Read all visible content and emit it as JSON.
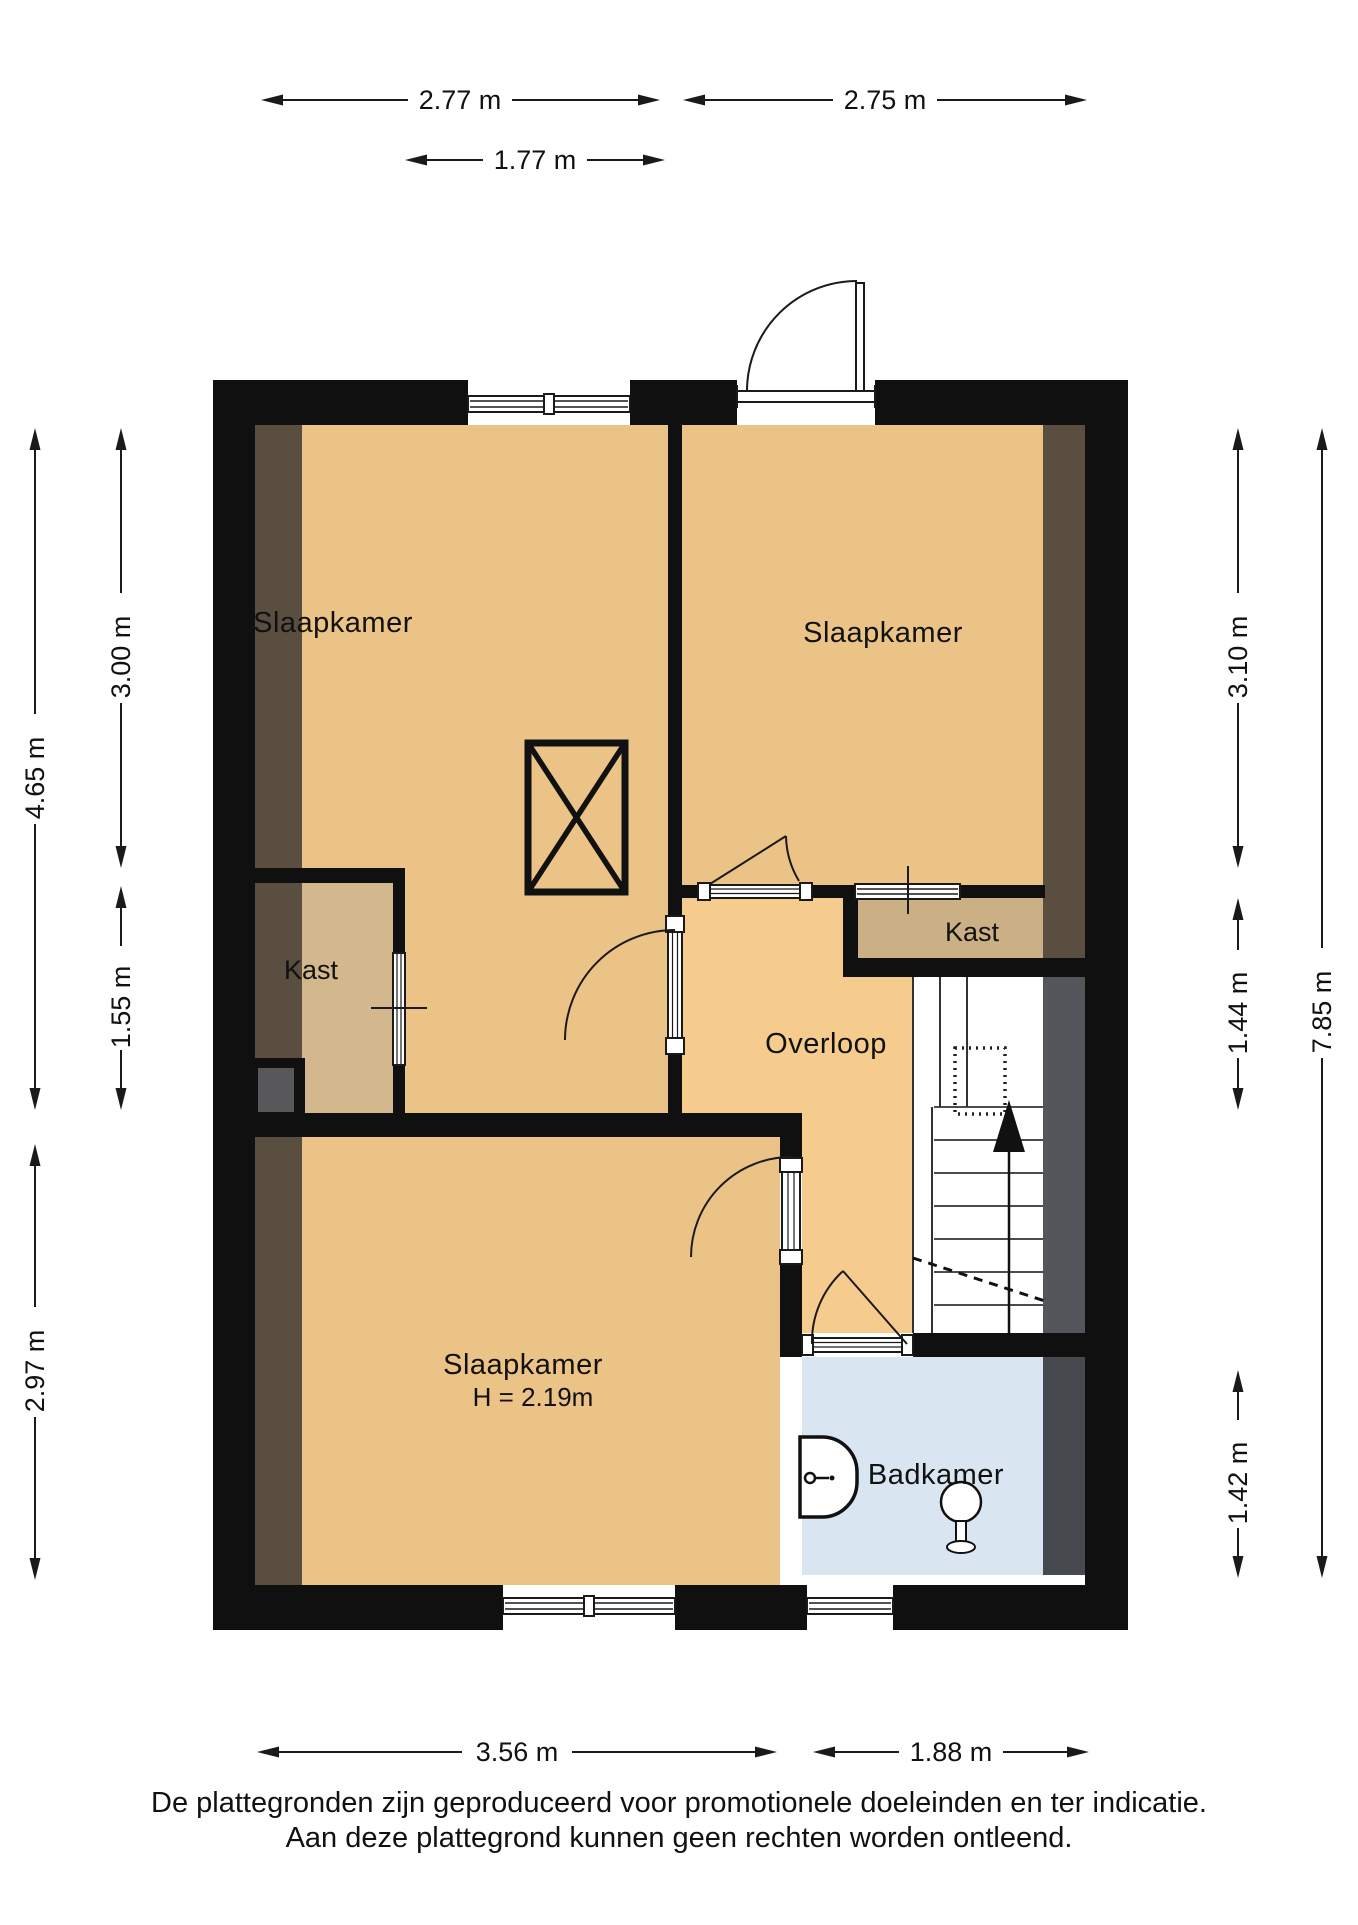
{
  "rooms": {
    "bedroom_top_left": "Slaapkamer",
    "bedroom_top_right": "Slaapkamer",
    "bedroom_bottom": "Slaapkamer",
    "bedroom_bottom_height": "H = 2.19m",
    "closet_left": "Kast",
    "closet_right": "Kast",
    "landing": "Overloop",
    "bathroom": "Badkamer"
  },
  "dimensions": {
    "top_left_width": "2.77 m",
    "top_right_width": "2.75 m",
    "top_inner_width": "1.77 m",
    "left_total": "4.65 m",
    "left_upper": "3.00 m",
    "left_lower": "1.55 m",
    "left_bottom": "2.97 m",
    "right_upper": "3.10 m",
    "right_mid": "1.44 m",
    "right_total": "7.85 m",
    "right_bottom": "1.42 m",
    "bottom_left": "3.56 m",
    "bottom_right": "1.88 m"
  },
  "footer": {
    "line1": "De plattegronden zijn geproduceerd voor promotionele doeleinden en ter indicatie.",
    "line2": "Aan deze plattegrond kunnen geen rechten worden ontleend."
  },
  "colors": {
    "wall": "#101010",
    "bedroom": "#ebc386",
    "landing": "#f6cb8e",
    "closet_left": "#d3b78d",
    "closet_right": "#cbb086",
    "bathroom": "#d9e6f1",
    "shadow_brown": "#594e3f",
    "shadow_gray": "#53565a",
    "shadow_gray_dark": "#46494d",
    "duct_gray": "#58585a",
    "line": "#1a1a1a"
  }
}
